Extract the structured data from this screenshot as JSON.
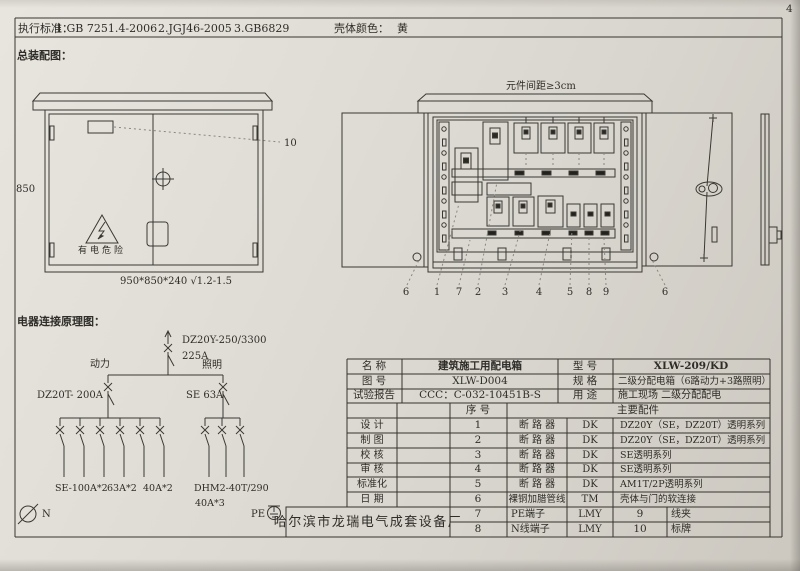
{
  "page": {
    "number": "4"
  },
  "header": {
    "label": "执行标准：",
    "standards": [
      "1.GB 7251.4-2006",
      "2.JGJ46-2005",
      "3.GB6829"
    ],
    "shell_color_label": "壳体颜色：",
    "shell_color_value": "黄"
  },
  "assembly": {
    "title": "总装配图：",
    "closed": {
      "height_dim": "850",
      "callout": "10",
      "warning_text": "有电危险",
      "size_note": "950*850*240 √1.2-1.5"
    },
    "open": {
      "spacing_note": "元件间距≥3cm",
      "callouts": [
        "6",
        "1",
        "7",
        "2",
        "3",
        "4",
        "5",
        "8",
        "9",
        "6"
      ]
    }
  },
  "schematic": {
    "title": "电器连接原理图：",
    "main_model": "DZ20Y-250/3300",
    "main_rating": "225A",
    "branch_power": "动力",
    "branch_lighting": "照明",
    "power_breaker": "DZ20T- 200A",
    "lighting_breaker": "SE  63A",
    "power_groups": [
      "SE-100A*2",
      "63A*2",
      "40A*2"
    ],
    "lighting_model": "DHM2-40T/290",
    "lighting_rating": "40A*3",
    "neutral": "N",
    "pe": "PE"
  },
  "spec_table": {
    "info": {
      "r1": {
        "l": "名  称",
        "v": "建筑施工用配电箱",
        "l2": "型  号",
        "v2": "XLW-209/KD"
      },
      "r2": {
        "l": "图  号",
        "v": "XLW-D004",
        "l2": "规  格",
        "v2": "二级分配电箱（6路动力+3路照明）"
      },
      "r3": {
        "l": "试验报告",
        "v": "CCC：C-032-10451B-S",
        "l2": "用  途",
        "v2": "施工现场 二级分配配电"
      }
    },
    "sub": {
      "serial": "序  号",
      "parts": "主要配件"
    },
    "sign_labels": [
      "设 计",
      "制 图",
      "校 核",
      "审 核",
      "标准化",
      "日 期"
    ],
    "parts": [
      {
        "no": "1",
        "name": "断 路 器",
        "brand": "DK",
        "desc": "DZ20Y（SE，DZ20T）透明系列"
      },
      {
        "no": "2",
        "name": "断 路 器",
        "brand": "DK",
        "desc": "DZ20Y（SE，DZ20T）透明系列"
      },
      {
        "no": "3",
        "name": "断 路 器",
        "brand": "DK",
        "desc": "SE透明系列"
      },
      {
        "no": "4",
        "name": "断 路 器",
        "brand": "DK",
        "desc": "SE透明系列"
      },
      {
        "no": "5",
        "name": "断 路 器",
        "brand": "DK",
        "desc": "AM1T/2P透明系列"
      },
      {
        "no": "6",
        "name": "裸铜加腊管线",
        "brand": "TM",
        "desc": "壳体与门的软连接"
      }
    ],
    "tail": [
      {
        "no": "7",
        "name": "PE端子",
        "brand": "LMY",
        "no2": "9",
        "name2": "线夹"
      },
      {
        "no": "8",
        "name": "N线端子",
        "brand": "LMY",
        "no2": "10",
        "name2": "标牌"
      }
    ],
    "factory": "哈尔滨市龙瑞电气成套设备厂"
  }
}
